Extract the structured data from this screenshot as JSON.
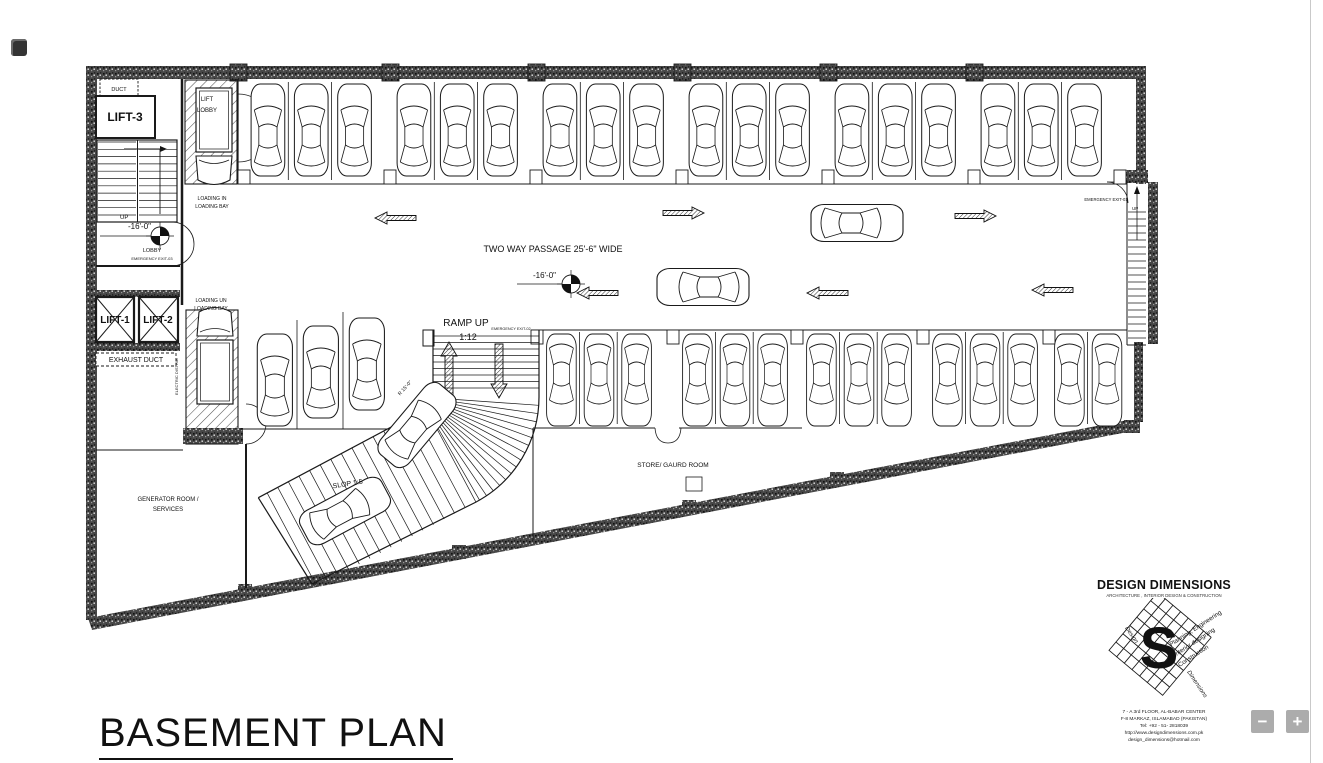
{
  "plan": {
    "title": "BASEMENT PLAN",
    "labels": {
      "duct": "DUCT",
      "lift3": "LIFT-3",
      "lift_lobby_1": "LIFT",
      "lift_lobby_2": "LOBBY",
      "up_left": "UP",
      "level_left": "-16'-0\"",
      "lobby": "LOBBY",
      "emergency_exit_03": "EMERGENCY EXIT-03",
      "loading_in_1": "LOADING IN",
      "loading_in_2": "LOADING BAY",
      "lift1": "LIFT-1",
      "lift2": "LIFT-2",
      "exhaust_duct": "EXHAUST DUCT",
      "electric_room": "ELECTRIC DISTRIB",
      "loading_un_1": "LOADING UN",
      "loading_un_2": "LOADING BAY",
      "two_way_passage": "TWO WAY PASSAGE 25'-6\" WIDE",
      "level_center": "-16'-0\"",
      "ramp_up": "RAMP UP",
      "ramp_gradient": "1:12",
      "emergency_exit_02": "EMERGENCY EXIT-02",
      "ramp_slope": "SLOP 1:5",
      "ramp_radius": "R 15'-0\"",
      "generator_1": "GENERATOR ROOM /",
      "generator_2": "SERVICES",
      "store_guard": "STORE/ GAURD ROOM",
      "emergency_exit_01": "EMERGENCY EXIT-01",
      "up_right": "UP"
    }
  },
  "titleblock": {
    "firm": "DESIGN DIMENSIONS",
    "tagline": "ARCHITECTURE , INTERIOR DESIGN & CONSTRUCTION",
    "logo_letter": "S",
    "logo_word_1": "Design",
    "logo_word_2": "Dimensions",
    "services": [
      "Planning, Engineering",
      "Interior designing",
      "Construction"
    ],
    "address_1": "7 - A  3rd FLOOR, AL-BABAR CENTER",
    "address_2": "F-8 MARKAZ, ISLAMABAD (PAKISTAN)",
    "address_3": "Tel:  +92 - 51- 2818039",
    "address_4": "http://www.designdimensions.com.pk",
    "address_5": "design_dimensions@hotmail.com"
  },
  "controls": {
    "zoom_out": "−",
    "zoom_in": "+"
  }
}
